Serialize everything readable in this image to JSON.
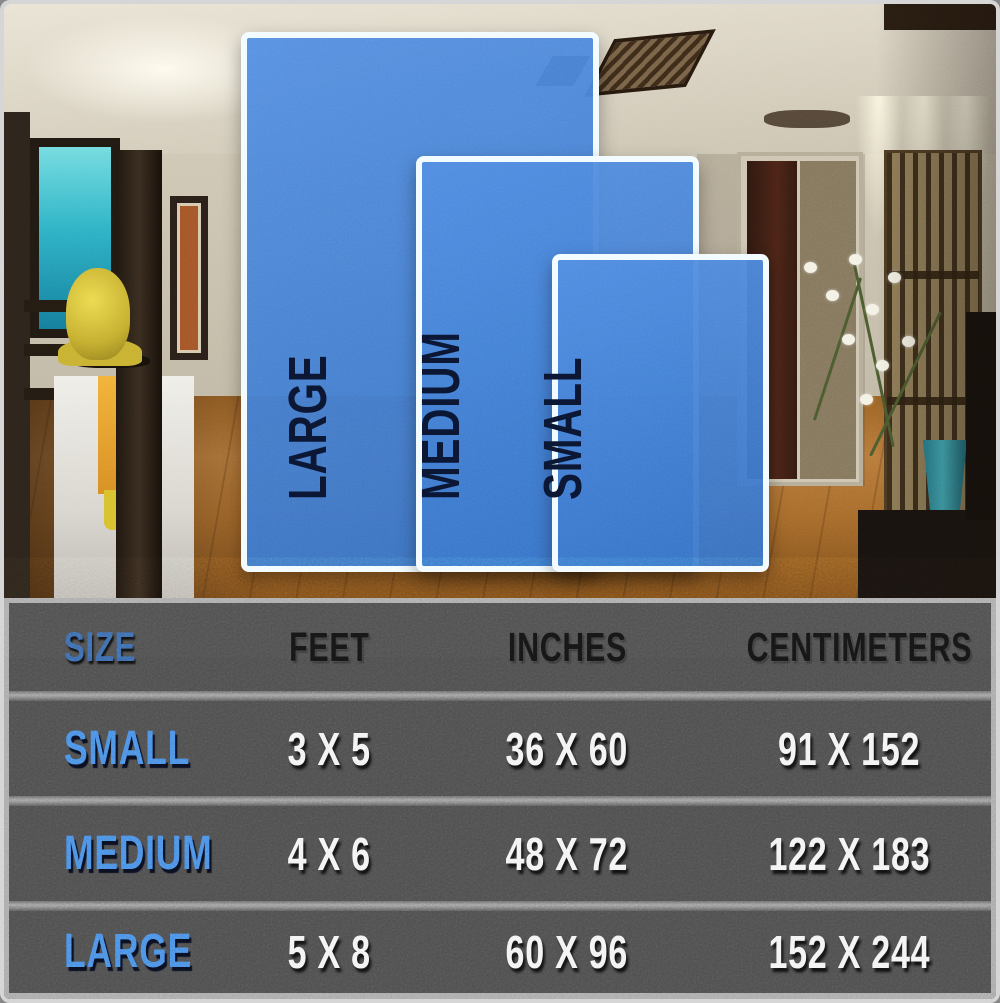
{
  "rugs": [
    {
      "id": "large",
      "label": "LARGE"
    },
    {
      "id": "medium",
      "label": "MEDIUM"
    },
    {
      "id": "small",
      "label": "SMALL"
    }
  ],
  "chart_data": {
    "type": "table",
    "columns": [
      "SIZE",
      "FEET",
      "INCHES",
      "CENTIMETERS"
    ],
    "rows": [
      {
        "size": "SMALL",
        "feet": "3 X 5",
        "inches": "36 X 60",
        "centimeters": "91 X 152"
      },
      {
        "size": "MEDIUM",
        "feet": "4 X 6",
        "inches": "48 X 72",
        "centimeters": "122 X 183"
      },
      {
        "size": "LARGE",
        "feet": "5 X 8",
        "inches": "60 X 96",
        "centimeters": "152 X 244"
      }
    ]
  },
  "colors": {
    "rug_blue": "#3e81de",
    "rug_border_white": "#f2fbff",
    "rug_label_navy": "#0b1633",
    "table_background": "#4e4e4e",
    "accent_blue": "#4a8de4",
    "value_white": "#f3f3f3",
    "header_black": "#151515"
  }
}
